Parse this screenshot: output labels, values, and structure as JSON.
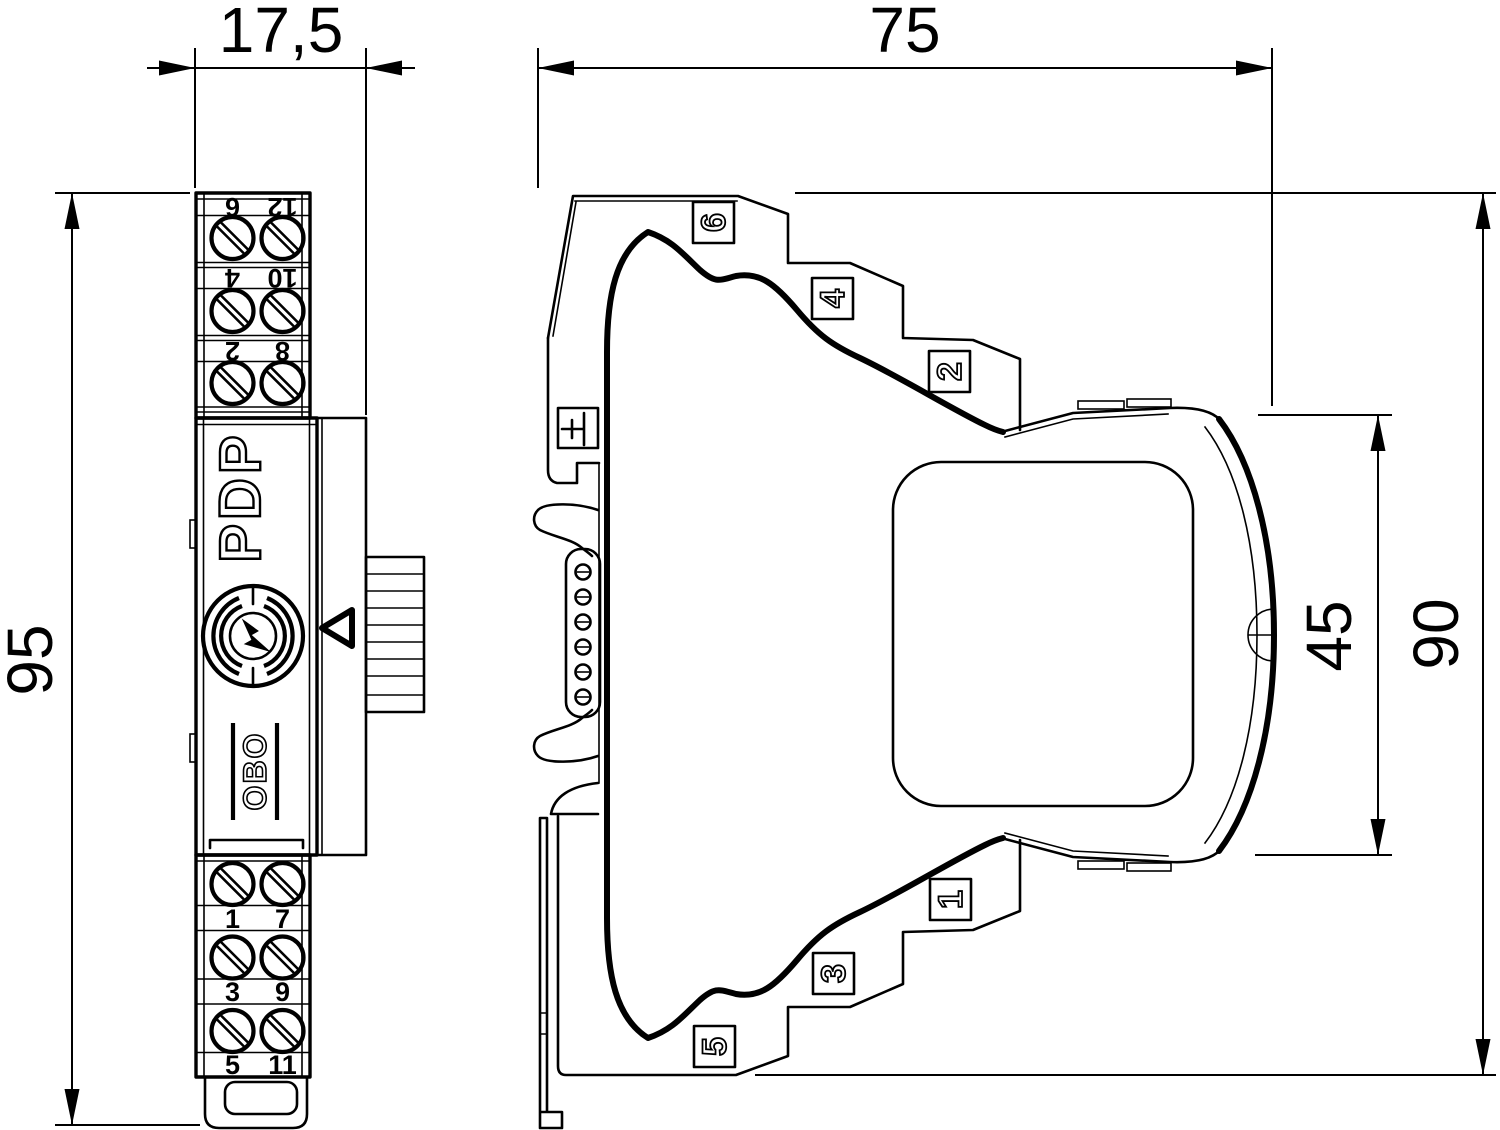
{
  "dims": {
    "front_width": "17,5",
    "total_width": "75",
    "front_height": "95",
    "module_height": "45",
    "body_height": "90"
  },
  "front_view": {
    "product": "PDP",
    "brand": "OBO",
    "top_terminals": [
      {
        "l": "6",
        "r": "12"
      },
      {
        "l": "4",
        "r": "10"
      },
      {
        "l": "2",
        "r": "8"
      }
    ],
    "bottom_terminals": [
      {
        "l": "1",
        "r": "7"
      },
      {
        "l": "3",
        "r": "9"
      },
      {
        "l": "5",
        "r": "11"
      }
    ]
  },
  "side_view": {
    "markers_top": [
      "6",
      "4",
      "2"
    ],
    "markers_bottom": [
      "1",
      "3",
      "5"
    ]
  }
}
